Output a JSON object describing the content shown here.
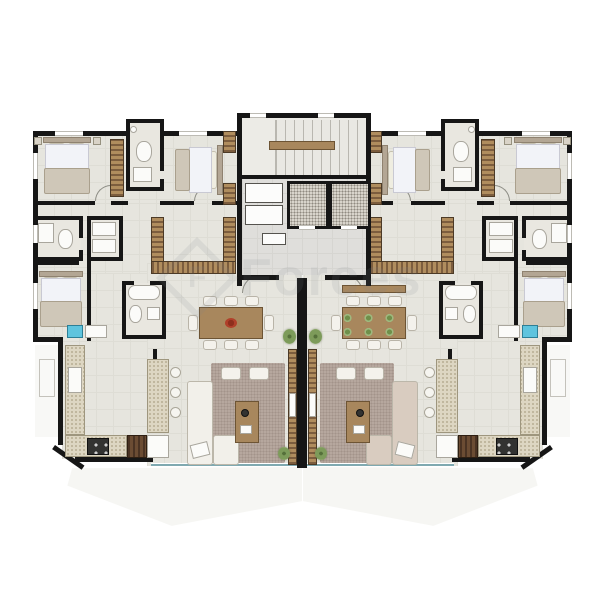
{
  "watermark": {
    "text": "Forces",
    "logo": "diamond-monogram",
    "monogram_letter": "F"
  },
  "palette": {
    "background": "#ffffff",
    "walls": "#161616",
    "floor": "#e6e5de",
    "hall_floor": "#dfdedb",
    "wood": "#a8875d",
    "wardrobe_hatch": "#7c5d3e",
    "rug": "#b6a79e",
    "glass_rail": "#7fa9b0",
    "sofa_left": "#f2f0ea",
    "sofa_right": "#d9ccc0",
    "centerpiece_red": "#b0402a",
    "plates_green": "#7d9b5a",
    "laundry_tank_blue": "#5fc4de"
  },
  "floorplan": {
    "type": "residential-floor-plan",
    "description": "Two mirrored apartment units flanking a central core",
    "core": {
      "rooms": [
        "staircase",
        "elevator-1",
        "elevator-2",
        "hall"
      ]
    },
    "units": [
      {
        "id": "left-apartment",
        "rooms": [
          "bedroom-1",
          "bathroom-1",
          "bedroom-2",
          "bathroom-2",
          "bedroom-3",
          "walk-in-closet",
          "master-bathroom",
          "laundry",
          "kitchen",
          "dining-room",
          "living-room",
          "balcony"
        ]
      },
      {
        "id": "right-apartment",
        "mirrored": true,
        "rooms": [
          "bedroom-1",
          "bathroom-1",
          "bedroom-2",
          "bathroom-2",
          "bedroom-3",
          "walk-in-closet",
          "master-bathroom",
          "laundry",
          "kitchen",
          "dining-room",
          "living-room",
          "balcony"
        ]
      }
    ]
  }
}
